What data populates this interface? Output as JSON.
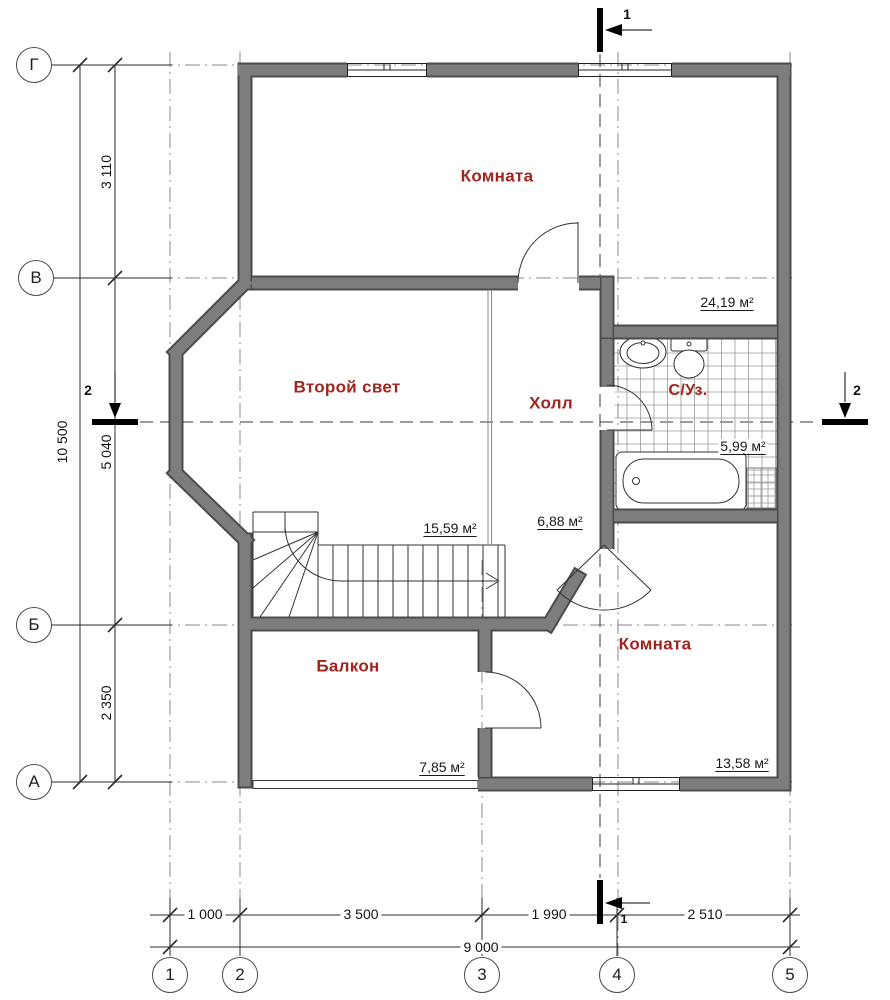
{
  "axis_bubbles": {
    "rows": [
      "Г",
      "В",
      "Б",
      "А"
    ],
    "cols": [
      "1",
      "2",
      "3",
      "4",
      "5"
    ]
  },
  "dimensions": {
    "left_total": "10 500",
    "left_segments": [
      "3 110",
      "5 040",
      "2 350"
    ],
    "bottom_segments": [
      "1 000",
      "3 500",
      "1 990",
      "2 510"
    ],
    "bottom_total": "9 000"
  },
  "section_markers": {
    "top": "1",
    "bottom": "1",
    "left": "2",
    "right": "2"
  },
  "rooms": [
    {
      "name": "Комната",
      "area": "24,19 м²"
    },
    {
      "name": "Второй свет",
      "area": "15,59 м²"
    },
    {
      "name": "Холл",
      "area": "6,88 м²"
    },
    {
      "name": "С/Уз.",
      "area": "5,99 м²"
    },
    {
      "name": "Балкон",
      "area": "7,85 м²"
    },
    {
      "name": "Комната",
      "area": "13,58 м²"
    }
  ],
  "colors": {
    "room_label": "#a2241e",
    "wall_fill": "#7d7d7d",
    "wall_outline": "#4c4c4c",
    "line": "#2b2b2b"
  }
}
